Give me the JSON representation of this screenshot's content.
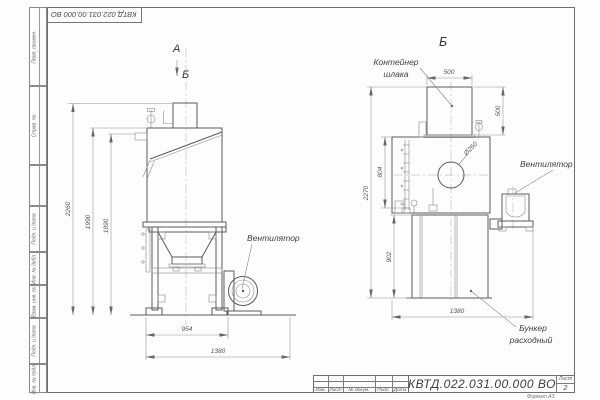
{
  "corner": {
    "designation": "КВТД.022.031.00.000 ВО"
  },
  "sidebar": {
    "items": [
      {
        "label": "Перв. примен."
      },
      {
        "label": "Справ. №"
      },
      {
        "label": ""
      },
      {
        "label": "Подп. и дата"
      },
      {
        "label": "Инв. № дубл."
      },
      {
        "label": "Взам. инв. №"
      },
      {
        "label": "Подп. и дата"
      },
      {
        "label": "Инв. № подл."
      }
    ]
  },
  "title_block": {
    "designation": "КВТД.022.031.00.000  ВО",
    "sheet_label": "Лист",
    "sheet_number": "2",
    "columns": [
      "Изм.",
      "Лист",
      "№ докум.",
      "Подп.",
      "Дата"
    ],
    "format_note": "Формат А3"
  },
  "views": {
    "left": {
      "label_a": "А",
      "label_b_arrow": "Б",
      "fan_label": "Вентилятор",
      "dims": {
        "height_total": "2260",
        "height_body": "1990",
        "height_rail": "1890",
        "width_frame": "954",
        "width_total": "1380"
      }
    },
    "right": {
      "label": "Б",
      "container_label_line1": "Контейнер",
      "container_label_line2": "шлака",
      "fan_label": "Вентилятор",
      "bunker_label_line1": "Бункер",
      "bunker_label_line2": "расходный",
      "dims": {
        "container_width": "500",
        "container_height": "500",
        "inlet_diameter": "Ø250",
        "side_height": "804",
        "height_total": "2270",
        "bunker_height": "902",
        "width_total": "1380"
      }
    }
  }
}
